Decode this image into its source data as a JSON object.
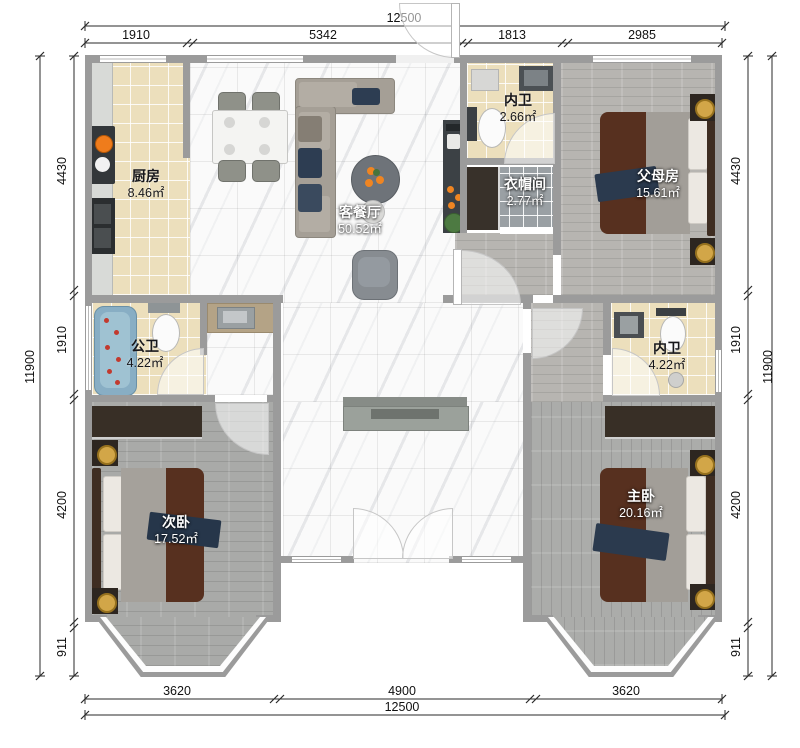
{
  "dimensions": {
    "top": {
      "total": "12500",
      "segments": [
        "1910",
        "5342",
        "1813",
        "2985"
      ]
    },
    "bottom": {
      "total": "12500",
      "segments": [
        "3620",
        "4900",
        "3620"
      ]
    },
    "left": {
      "total": "11900",
      "segments": [
        "4430",
        "1910",
        "4200",
        "911"
      ]
    },
    "right": {
      "total": "11900",
      "segments": [
        "4430",
        "1910",
        "4200",
        "911"
      ]
    }
  },
  "rooms": {
    "kitchen": {
      "name": "厨房",
      "area": "8.46㎡"
    },
    "living_dining": {
      "name": "客餐厅",
      "area": "50.52㎡"
    },
    "ensuite_top": {
      "name": "内卫",
      "area": "2.66㎡"
    },
    "cloakroom": {
      "name": "衣帽间",
      "area": "2.77㎡"
    },
    "parents_room": {
      "name": "父母房",
      "area": "15.61㎡"
    },
    "public_bath": {
      "name": "公卫",
      "area": "4.22㎡"
    },
    "ensuite_right": {
      "name": "内卫",
      "area": "4.22㎡"
    },
    "second_bedroom": {
      "name": "次卧",
      "area": "17.52㎡"
    },
    "master_bedroom": {
      "name": "主卧",
      "area": "20.16㎡"
    }
  },
  "colors": {
    "wall": "#9b9b9b",
    "marble_floor": "#fafafa",
    "beige_tile": "#ecdfbc",
    "wood_floor": "#a9aaa8",
    "accent_orange": "#ef8522",
    "navy_throw": "#2b3a4e",
    "maroon_quilt": "#57301f",
    "bathtub_blue": "#88aec4",
    "lamp_gold": "#d2a648"
  }
}
